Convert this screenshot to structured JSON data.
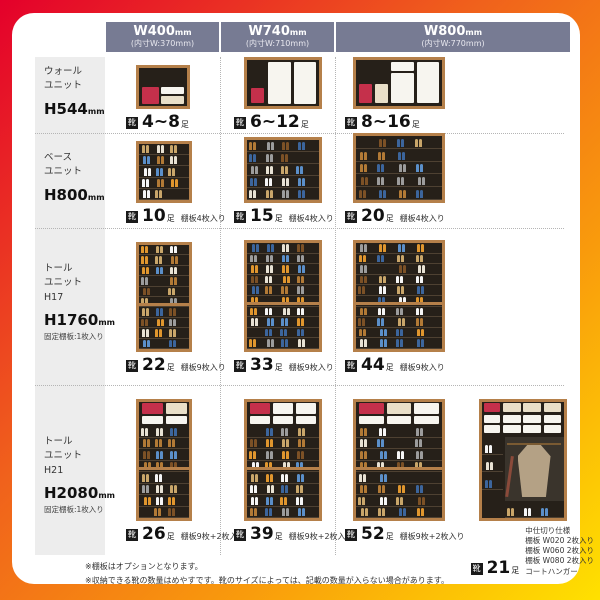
{
  "header": {
    "columns": [
      {
        "size": "W400",
        "size_unit": "mm",
        "inner": "(内寸W:370mm)"
      },
      {
        "size": "W740",
        "size_unit": "mm",
        "inner": "(内寸W:710mm)"
      },
      {
        "size": "W800",
        "size_unit": "mm",
        "inner": "(内寸W:770mm)"
      }
    ]
  },
  "badge_label": "靴",
  "unit_label": "足",
  "rows": [
    {
      "label": {
        "line1": "ウォール",
        "line2": "ユニット",
        "line3": "",
        "height": "H544",
        "height_unit": "mm",
        "note": ""
      },
      "cells": [
        {
          "count": "4~8",
          "note": ""
        },
        {
          "count": "6~12",
          "note": ""
        },
        {
          "count": "8~16",
          "note": ""
        }
      ]
    },
    {
      "label": {
        "line1": "ベース",
        "line2": "ユニット",
        "line3": "",
        "height": "H800",
        "height_unit": "mm",
        "note": ""
      },
      "cells": [
        {
          "count": "10",
          "note": "棚板4枚入り"
        },
        {
          "count": "15",
          "note": "棚板4枚入り"
        },
        {
          "count": "20",
          "note": "棚板4枚入り"
        }
      ]
    },
    {
      "label": {
        "line1": "トール",
        "line2": "ユニット",
        "line3": "H17",
        "height": "H1760",
        "height_unit": "mm",
        "note": "固定棚板:1枚入り"
      },
      "cells": [
        {
          "count": "22",
          "note": "棚板9枚入り"
        },
        {
          "count": "33",
          "note": "棚板9枚入り"
        },
        {
          "count": "44",
          "note": "棚板9枚入り"
        }
      ]
    },
    {
      "label": {
        "line1": "トール",
        "line2": "ユニット",
        "line3": "H21",
        "height": "H2080",
        "height_unit": "mm",
        "note": "固定棚板:1枚入り"
      },
      "cells": [
        {
          "count": "26",
          "note": "棚板9枚+2枚入り"
        },
        {
          "count": "39",
          "note": "棚板9枚+2枚入り"
        },
        {
          "count": "52",
          "note": "棚板9枚+2枚入り"
        }
      ],
      "extra_cell": {
        "count": "21",
        "note_lines": [
          "中仕切り仕様",
          "棚板 W020 2枚入り",
          "棚板 W060 2枚入り",
          "棚板 W080 2枚入り",
          "コートハンガー"
        ]
      }
    }
  ],
  "footnotes": [
    "※棚板はオプションとなります。",
    "※収納できる靴の数量はめやすです。靴のサイズによっては、記載の数量が入らない場合があります。"
  ],
  "colors": {
    "header_bg": "#777b93",
    "label_bg": "#ededed",
    "wood_frame": "#b5804a",
    "red_box": "#c5304b"
  }
}
